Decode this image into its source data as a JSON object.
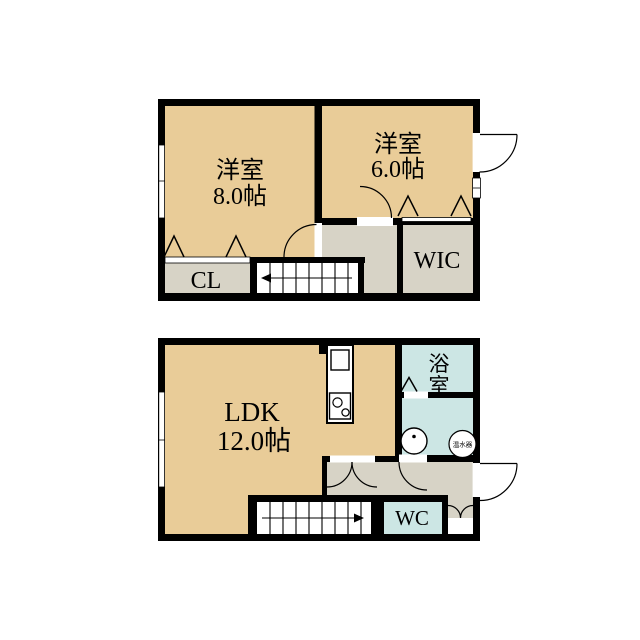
{
  "colors": {
    "room_fill": "#E9CC98",
    "storage_fill": "#D7D3C6",
    "wet_fill": "#CCE6E4",
    "wall": "#000000",
    "background": "#FFFFFF"
  },
  "upper_floor": {
    "bedroom_large": {
      "name": "洋室",
      "area": "8.0帖"
    },
    "bedroom_small": {
      "name": "洋室",
      "area": "6.0帖"
    },
    "closet_label": "CL",
    "walk_in_closet_label": "WIC"
  },
  "lower_floor": {
    "ldk": {
      "name": "LDK",
      "area": "12.0帖"
    },
    "bathroom_char_top": "浴",
    "bathroom_char_bottom": "室",
    "toilet_label": "WC",
    "water_heater_label": "温水器"
  }
}
